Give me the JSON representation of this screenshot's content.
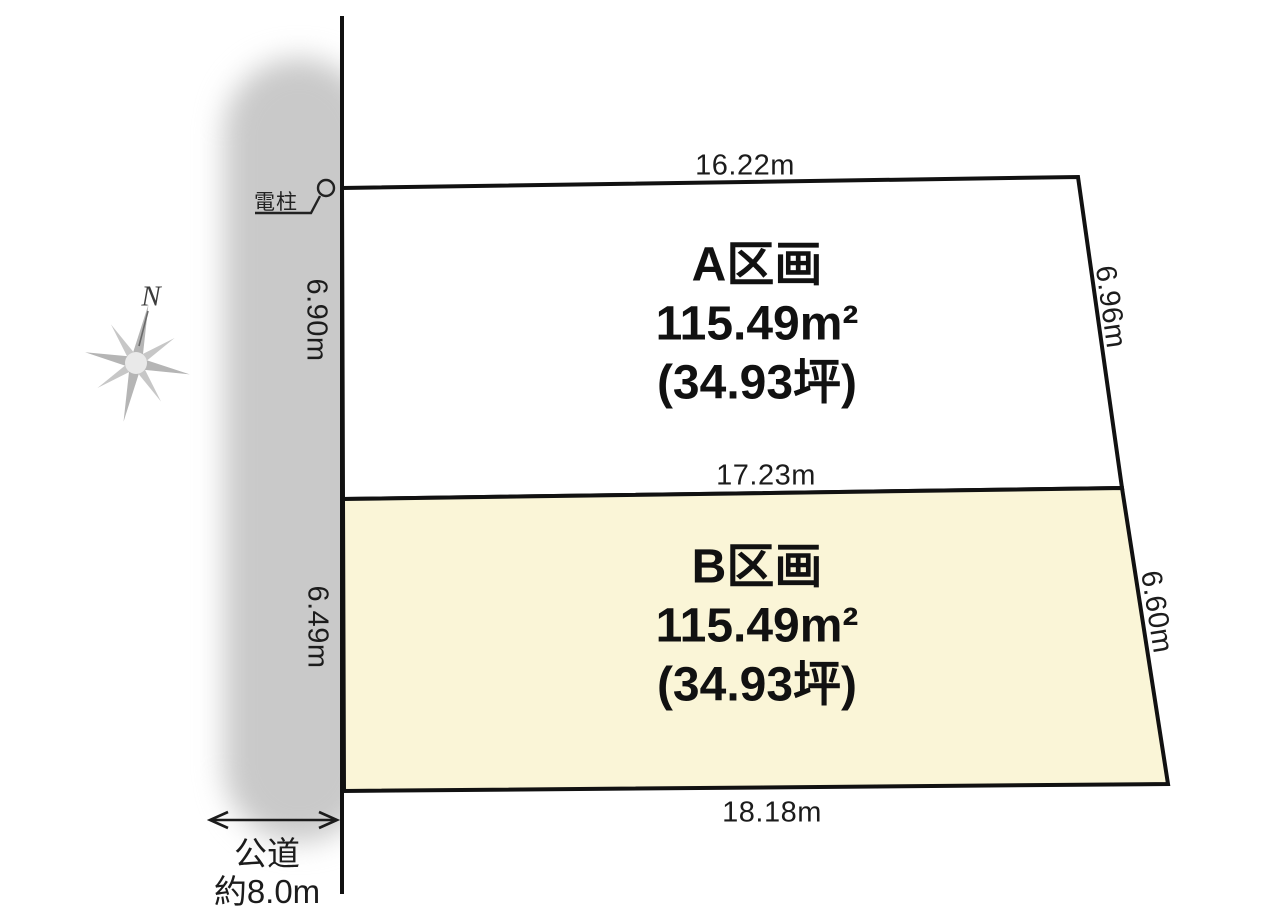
{
  "colors": {
    "outline": "#111111",
    "parcel_a_fill": "#ffffff",
    "parcel_b_fill": "#faf5d7",
    "road_strip": "#c9c9c9",
    "compass_gray": "#b0b0b0"
  },
  "compass": {
    "north_label": "N"
  },
  "road": {
    "name": "公道",
    "width": "約8.0m"
  },
  "utility_pole": {
    "label": "電柱"
  },
  "dimensions": {
    "a_top": "16.22m",
    "a_left": "6.90m",
    "a_right": "6.96m",
    "ab_boundary": "17.23m",
    "b_left": "6.49m",
    "b_right": "6.60m",
    "b_bottom": "18.18m"
  },
  "parcels": {
    "a": {
      "name": "A区画",
      "area_m2": "115.49m²",
      "area_tsubo": "(34.93坪)",
      "fill": "#ffffff"
    },
    "b": {
      "name": "B区画",
      "area_m2": "115.49m²",
      "area_tsubo": "(34.93坪)",
      "fill": "#faf5d7"
    }
  }
}
